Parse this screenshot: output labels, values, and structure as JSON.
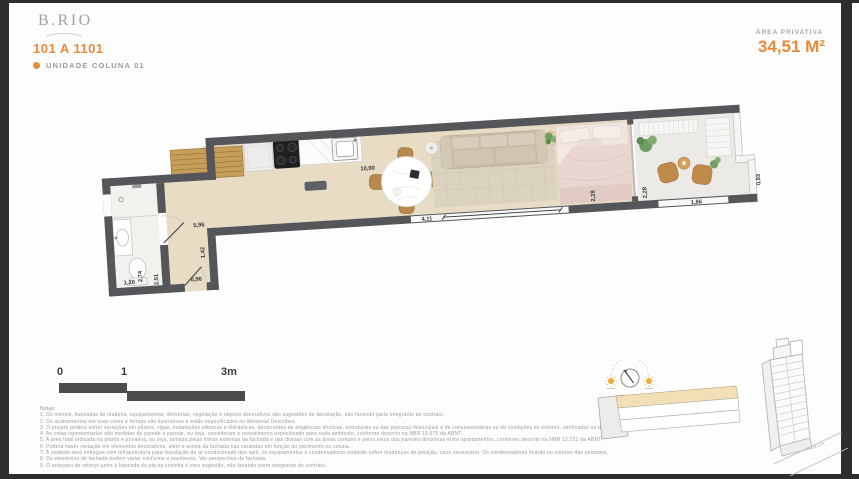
{
  "header": {
    "logo": "B.RIO",
    "unit_code": "101 A 1101",
    "unit_label": "UNIDADE COLUNA 01",
    "area_label": "ÁREA PRIVATIVA",
    "area_value": "34,51 M²"
  },
  "colors": {
    "accent": "#E98A3C",
    "wall": "#55565A",
    "wood_floor": "#E9DCC5",
    "unit_highlight": "#F2DFB6"
  },
  "plan": {
    "dimensions": [
      "10,90",
      "5,96",
      "1,42",
      "0,96",
      "1,20",
      "2,74",
      "2,51",
      "4,11",
      "2,28",
      "2,28",
      "1,86",
      "0,93"
    ]
  },
  "scale_bar": {
    "labels": [
      "0",
      "1",
      "3m"
    ]
  },
  "notes": {
    "title": "Notas:",
    "items": [
      "1. Os móveis, bancadas de madeira, equipamentos, divisórias, vegetação e objetos decorativos são sugestões de decoração, não fazendo parte integrante do contrato.",
      "2. Os acabamentos em suas cores e formas são ilustrativos e estão especificados no Memorial Descritivo.",
      "3. O projeto poderá sofrer variações em pilares, vigas, instalações elétricas e hidráulicas, decorrentes de exigências técnicas, estruturais ou das posturas municipais e de concessionárias ou de condições do entorno, verificadas no decorrer da obra.",
      "4. As cotas representadas são medidas de parede a parede, ou seja, consideram o revestimento especificado para cada ambiente, conforme descrito na NBR 15.575 da ABNT.",
      "5. A área total indicada na planta é privativa, ou seja, tomada pelas linhas externas da fachada e das divisas com as áreas comuns e pelos eixos das paredes divisórias entre apartamentos, conforme descrito na NBR 12.721 da ABNT.",
      "6. Poderá haver variação em elementos decorativos, além e acima da fachada nas varandas em função do pavimento ou coluna.",
      "7. A unidade será entregue com infraestrutura para instalação de ar-condicionado tipo split, os equipamentos e condensadoras poderão sofrer mudanças de posição, caso necessário. Os condensadores ficarão no exterior das unidades.",
      "8. Os elementos de fachada podem variar conforme o pavimento. Ver perspectiva de fachada.",
      "9. O anteparo de reforço junto à bancada da pia na cozinha é uma sugestão, não fazendo parte integrante do contrato."
    ]
  },
  "building_sketch": {
    "street_label": "RUA"
  }
}
